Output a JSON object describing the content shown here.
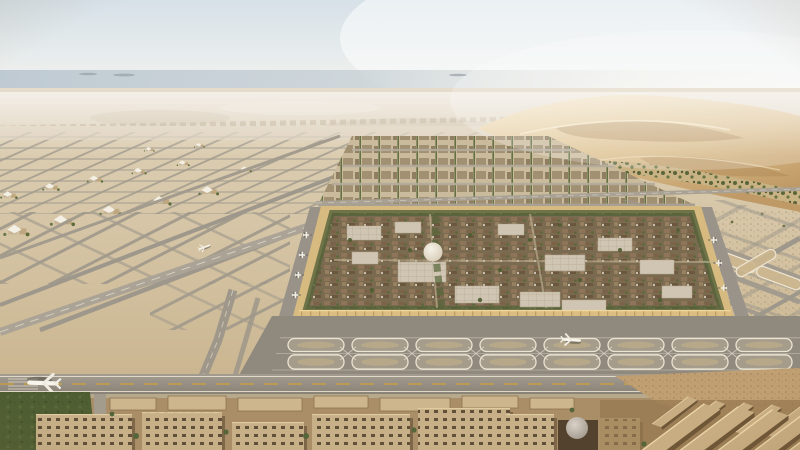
{
  "scene": {
    "type": "architectural aerial render",
    "description": "Aerial desert view of a vast master-planned airport city: a walled square medina-style district with a white central dome sits amid a huge grid of runways and looping taxiways, golden dunes and a hazy horizon behind, tree belts and flat-roofed sand-colored courtyard blocks in the foreground, with aircraft on the runway, taxiways and parked at the square's gates.",
    "setting": "desert plain with dune ridge upper right",
    "time_of_day": "hazy daylight",
    "landmarks": {
      "central_walled_square": "dense low-rise city of brown roofs, trees, light roofed clusters and a white dome, ringed by a golden wall lined with aircraft gates",
      "runway_network": "parallel runways, diamond taxiway grids and stadium-shaped holding loops across the sand",
      "dune_ridge": "wind-sculpted golden dunes along the upper right horizon",
      "green_wadi": "diagonal tree-lined green belt between the dunes and the airfield",
      "foreground_city": "flat-roofed courtyard blocks, a small grey dome and long bar buildings at bottom",
      "left_villages": "clusters of low buildings with white tent canopies among the taxiway grid",
      "horizon": "pale blue haze band with faint distant hills"
    },
    "aircraft": {
      "on_main_runway": 1,
      "taxiing_near_loops": 1,
      "small_on_distant_taxiway": 1,
      "parked_at_square_gates": 20
    },
    "counts": {
      "loop_taxiway_rows": 2,
      "loops_per_row": 8,
      "horizon_islands": 3
    }
  },
  "palette": {
    "sky_top": "#d6e1e8",
    "sky_low": "#f4f2ec",
    "haze": "#bcc8d1",
    "far_sand": "#e6dccc",
    "field_sand_light": "#ddcfb4",
    "field_sand_dark": "#c9b48e",
    "dune_light": "#eed9ab",
    "dune_deep": "#c09a66",
    "dune_shadow": "#a37c49",
    "vegetation": "#5d6b3a",
    "tree_dark": "#47562e",
    "asphalt": "#9b9487",
    "asphalt_dark": "#8f897e",
    "marking_white": "#ece5d3",
    "centerline_amber": "#c79d44",
    "wall_gold": "#d7ba80",
    "city_roof_brown": "#8a7154",
    "city_roof_light": "#cfc5b2",
    "block_tan": "#c7b088",
    "block_shadow": "#6e5637",
    "dome_white": "#f6f2e8"
  }
}
